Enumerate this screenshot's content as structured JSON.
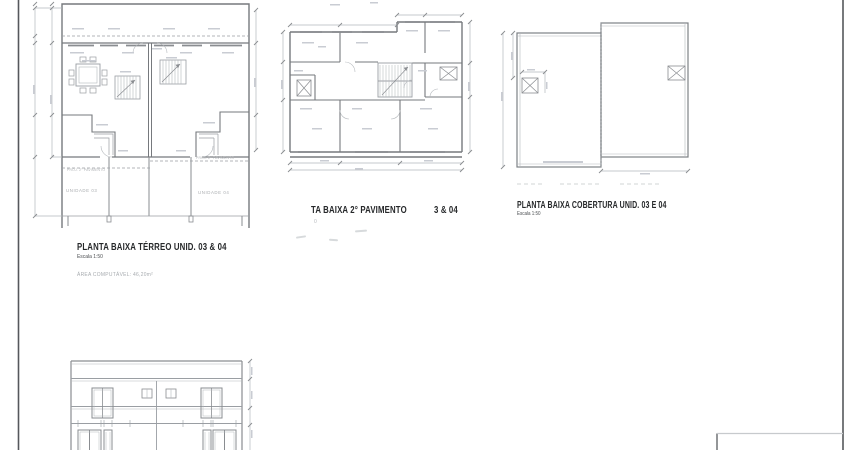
{
  "plans": {
    "terreo": {
      "title": "PLANTA BAIXA TÉRREO UNID. 03 & 04",
      "scale": "Escala 1:50",
      "area_note": "ÁREA COMPUTÁVEL: 46,20m²",
      "unit_labels": [
        "UNIDADE 03",
        "UNIDADE 04"
      ],
      "projection_label": "PROJ. 2° PAVIMENTO"
    },
    "segundo_pavimento": {
      "title_fragment_left": "TA BAIXA 2° PAVIMENTO",
      "title_fragment_right": "3 & 04",
      "scale_fragment": "0"
    },
    "cobertura": {
      "title": "PLANTA BAIXA COBERTURA UNID. 03 E 04",
      "scale": "Escala 1:50"
    }
  },
  "colors": {
    "sheet_border": "#55585c",
    "wall_line": "#76797d",
    "drawing_line": "#9a9ea3",
    "thin_line": "#b4b8bc",
    "title_text": "#26282a",
    "faded_text": "#aaadb0"
  }
}
